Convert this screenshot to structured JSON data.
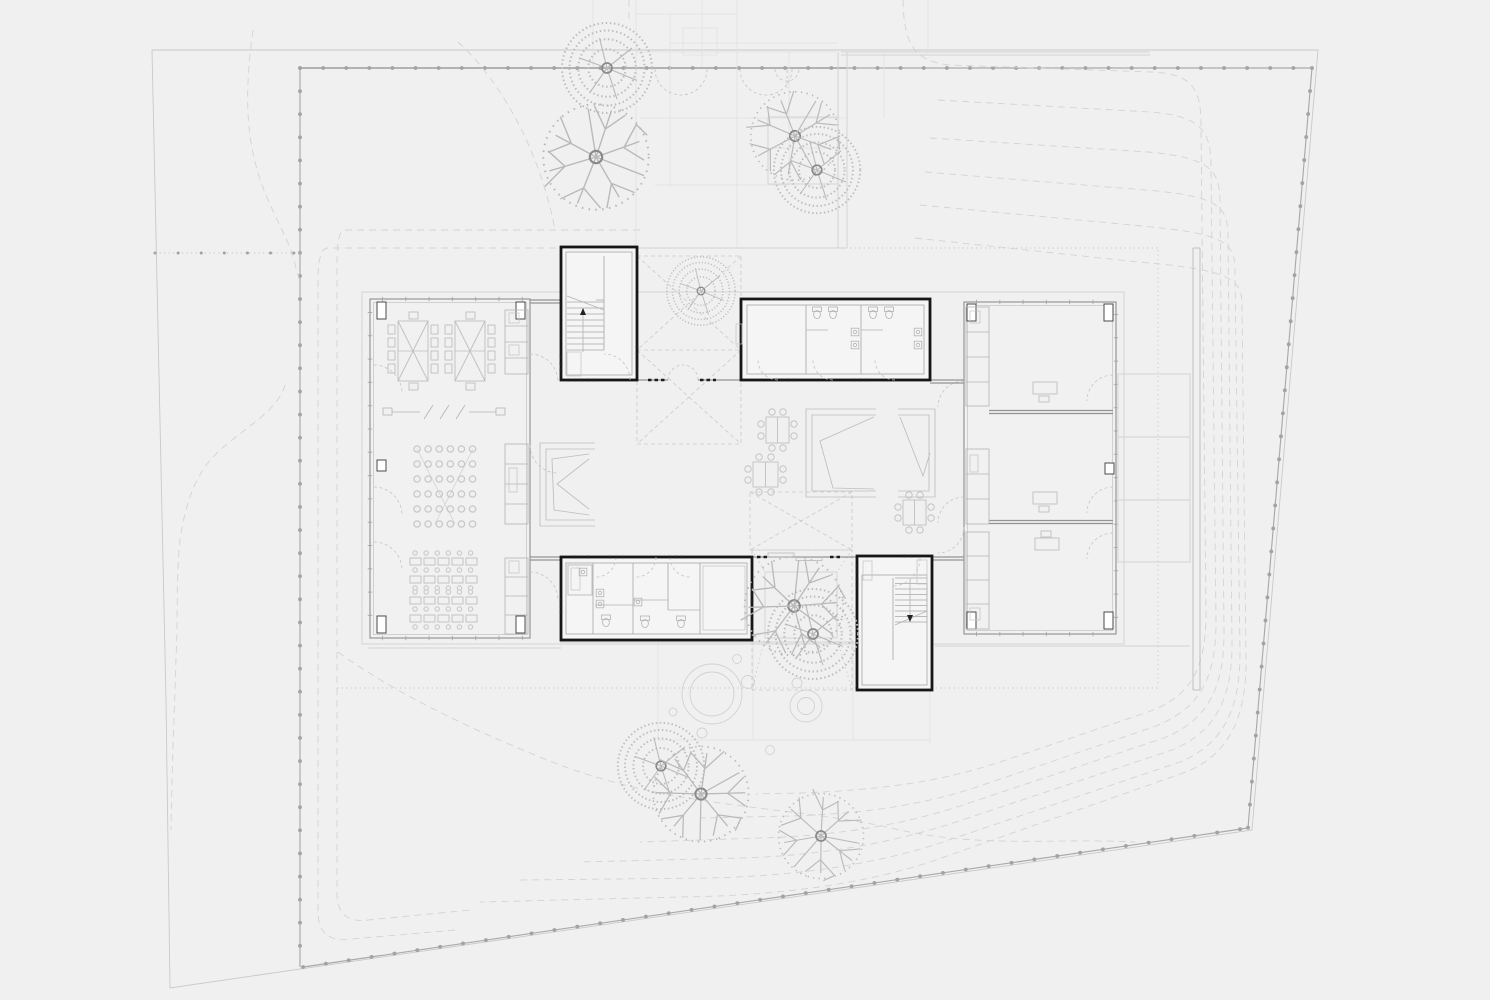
{
  "document": {
    "kind": "architectural-site-floor-plan",
    "visible_text_labels": [],
    "drawing_style": "grayscale line drawing on light gray background"
  },
  "palette": {
    "background": "#f0f0f0",
    "property_line": "#c9c9c9",
    "fence_line": "#a9a9a9",
    "contour_dashed": "#d3d3d3",
    "paving": "#e0e0e0",
    "wing_walls": "#939393",
    "core_walls_black": "#161616",
    "furniture": "#bdbdbd",
    "threshold_marks": "#1c1c1c"
  },
  "inventory": {
    "wings": 2,
    "stair_cores": 2,
    "sanitary_blocks": 2,
    "courtyards": 2,
    "skylight_markers": 3,
    "trees_leafy": 5,
    "trees_branched": 5,
    "meeting_tables": 2,
    "dining_tables": 3,
    "seating_nooks": 3,
    "classroom_desks": 20,
    "stool_grid": "6 x 6",
    "office_desks": 3,
    "terrace_bays": 3
  }
}
